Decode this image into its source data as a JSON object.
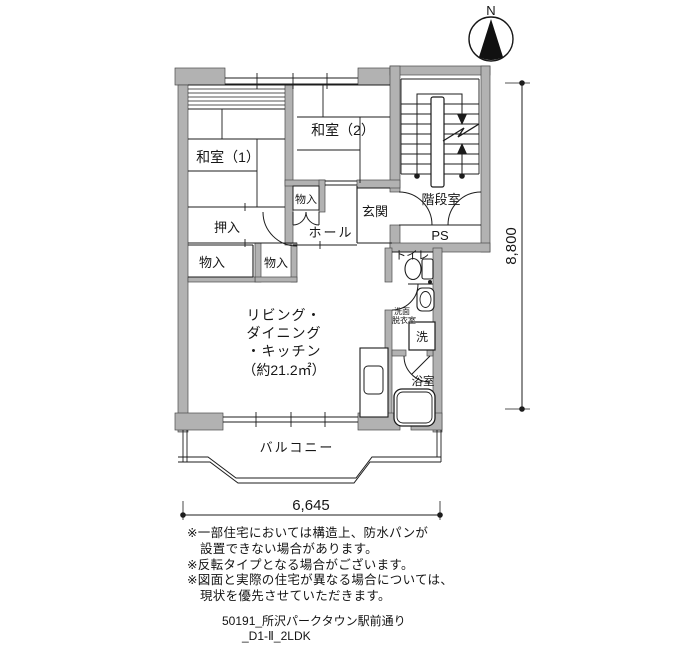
{
  "colors": {
    "wall_fill": "#b2b2b2",
    "line": "#1c1c1c"
  },
  "compass": {
    "north_label": "N"
  },
  "plan": {
    "rooms": {
      "washitsu1": "和室（1）",
      "washitsu2": "和室（2）",
      "closet_hall": "物入",
      "oshiire": "押入",
      "closet_left": "物入",
      "closet_right": "物入",
      "hall": "ホール",
      "genkan": "玄関",
      "stairwell": "階段室",
      "pipe_space": "PS",
      "toilet": "トイレ",
      "washroom_line1": "洗面",
      "washroom_line2": "脱衣室",
      "laundry": "洗",
      "bath": "浴室",
      "balcony": "バルコニー",
      "ldk_line1": "リビング・",
      "ldk_line2": "ダイニング",
      "ldk_line3": "・キッチン",
      "ldk_line4": "（約21.2㎡）"
    },
    "dimensions": {
      "width_mm": "6,645",
      "height_mm": "8,800"
    }
  },
  "notes": [
    "※一部住宅においては構造上、防水パンが",
    "設置できない場合があります。",
    "※反転タイプとなる場合がございます。",
    "※図面と実際の住宅が異なる場合については、",
    "現状を優先させていただきます。"
  ],
  "footer": {
    "line1": "50191_所沢パークタウン駅前通り",
    "line2": "_D1-Ⅱ_2LDK"
  }
}
